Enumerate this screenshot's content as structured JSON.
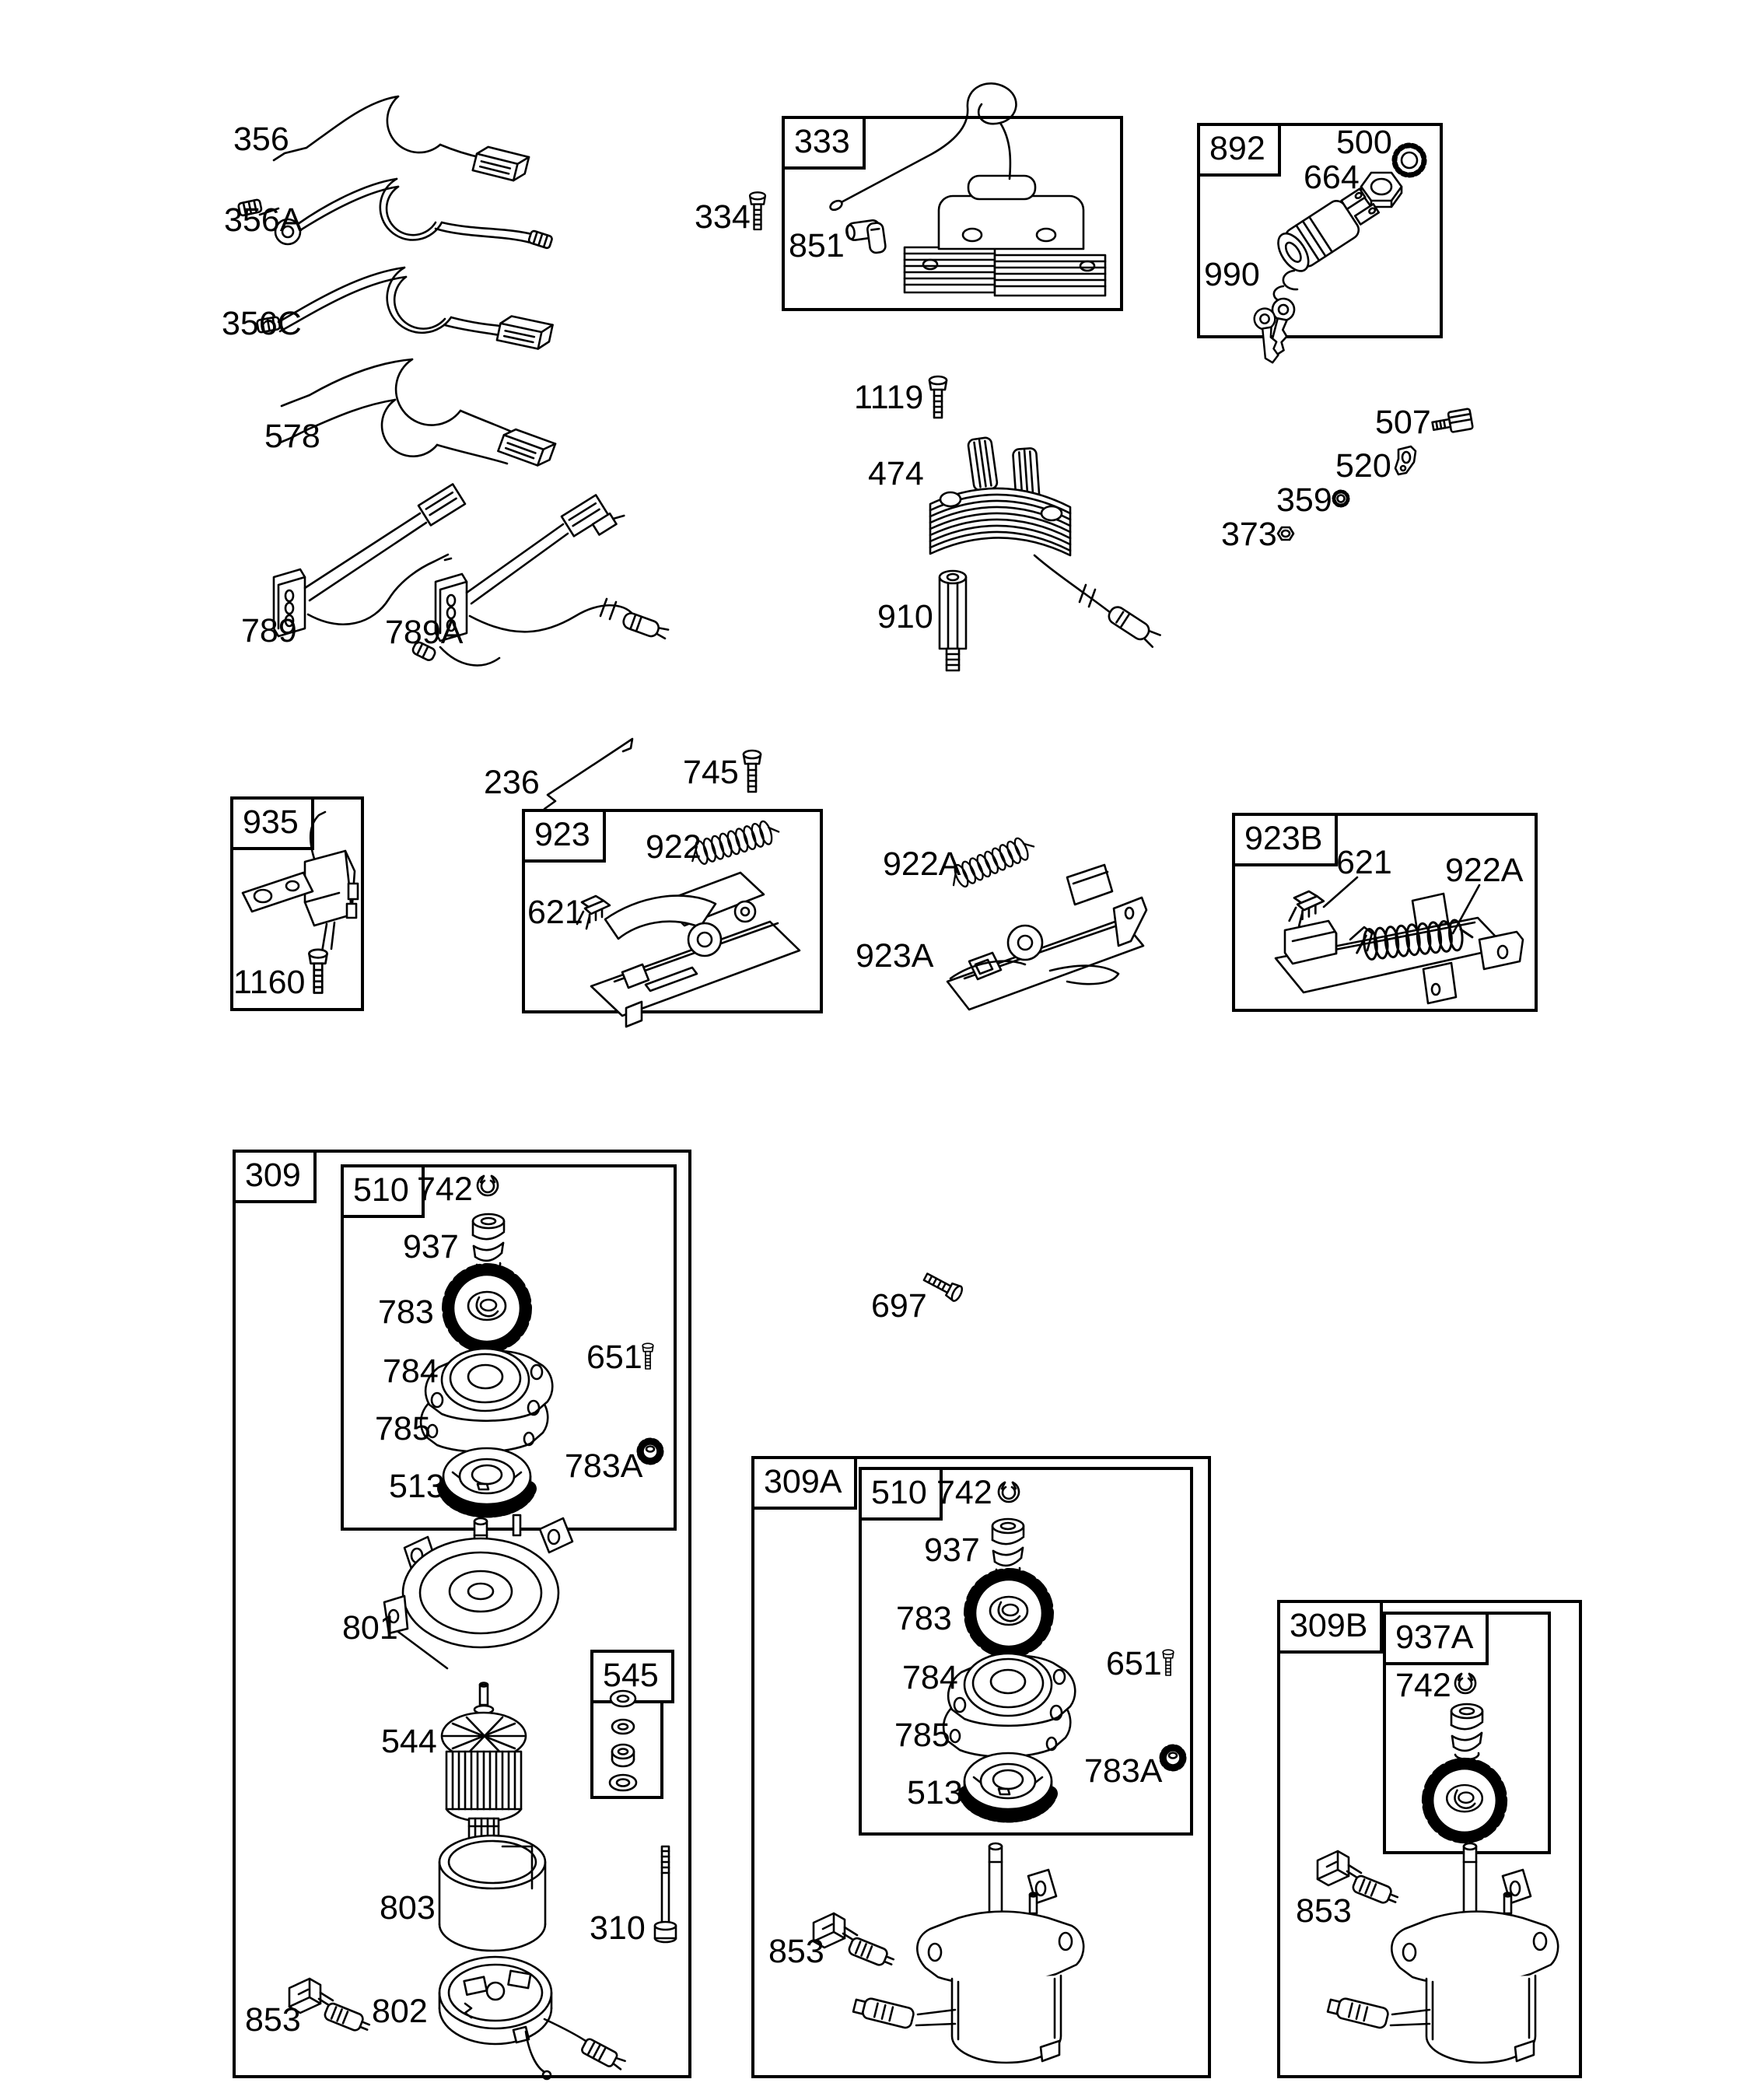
{
  "figure": {
    "background": "#ffffff",
    "line_color": "#000000"
  },
  "boxes": {
    "b333": "333",
    "b892": "892",
    "b935": "935",
    "b923": "923",
    "b923b": "923B",
    "b309": "309",
    "b510": "510",
    "b545": "545",
    "b309a": "309A",
    "b309b": "309B",
    "b937a": "937A"
  },
  "callouts": {
    "c356": "356",
    "c356a": "356A",
    "c356c": "356C",
    "c578": "578",
    "c334": "334",
    "c851": "851",
    "c500": "500",
    "c664": "664",
    "c990": "990",
    "c1119": "1119",
    "c474": "474",
    "c910": "910",
    "c507": "507",
    "c520": "520",
    "c359": "359",
    "c373": "373",
    "c789": "789",
    "c789a": "789A",
    "c236": "236",
    "c745": "745",
    "c1160": "1160",
    "c922": "922",
    "c621": "621",
    "c922a": "922A",
    "c923a": "923A",
    "c697": "697",
    "c742": "742",
    "c937": "937",
    "c783": "783",
    "c651": "651",
    "c784": "784",
    "c785": "785",
    "c513": "513",
    "c783a": "783A",
    "c801": "801",
    "c544": "544",
    "c803": "803",
    "c310": "310",
    "c802": "802",
    "c853": "853"
  }
}
